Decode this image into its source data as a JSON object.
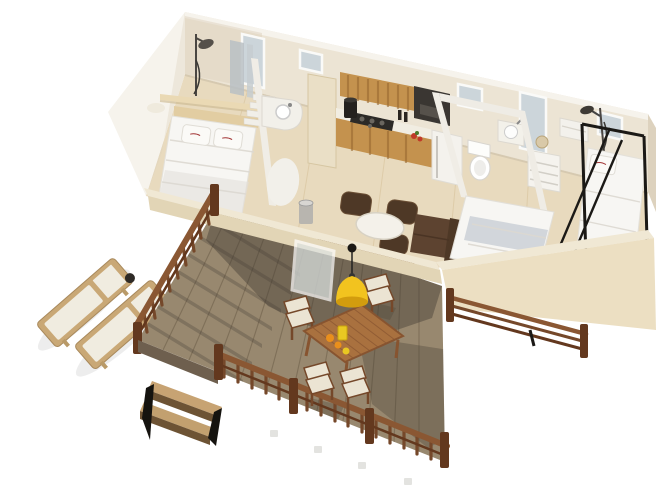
{
  "scene": {
    "description": "3D isometric cutaway rendering of a holiday mobile home with furnished interior and a wooden deck terrace, two sun loungers on the left, outdoor dining table with yellow pendant lamp on the deck",
    "building": {
      "areas": [
        {
          "name": "master-bedroom",
          "items": [
            "double-bed",
            "two-pillows-with-red-brand-mark",
            "headboard-shelf",
            "shower-column",
            "vanity-round-sink",
            "white-step-unit",
            "mirror-panels",
            "tall-window"
          ]
        },
        {
          "name": "kitchen",
          "items": [
            "cream-tall-cabinet",
            "wood-upper-cabinets",
            "range-hood",
            "cooktop",
            "coffee-maker",
            "counter",
            "fridge",
            "small-window"
          ]
        },
        {
          "name": "living-area",
          "items": [
            "brown-sofa",
            "three-brown-poufs",
            "white-oval-table",
            "metal-trash-bin",
            "brown-bench-cushion",
            "glass-entry-door"
          ]
        },
        {
          "name": "bathroom-wc",
          "items": [
            "toilet",
            "corner-washbasin",
            "drawer-unit",
            "window"
          ]
        },
        {
          "name": "kids-bedroom",
          "items": [
            "single-bed-grey-blanket",
            "bunk-bed-black-frame",
            "pillow-with-red-brand-mark",
            "wall-shower-head",
            "tall-window",
            "shelf-unit"
          ]
        }
      ]
    },
    "deck": {
      "items": [
        "decking-boards",
        "left-railing",
        "front-railing",
        "right-strip-railing",
        "two-step-stairs",
        "outdoor-dining-table",
        "four-folding-chairs-with-cream-cushions",
        "yellow-pendant-lamp",
        "oranges-and-lemon",
        "yellow-tumbler"
      ]
    },
    "garden": {
      "items": [
        "sun-lounger",
        "sun-lounger"
      ]
    }
  },
  "colors": {
    "bg": "#ffffff",
    "wall": "#ece4d4",
    "wall-bright": "#f6f3ec",
    "wall-shade": "#ddd2be",
    "floor": "#e8dabe",
    "floor-light": "#f0e6d0",
    "low-wall-top": "#f0e8d4",
    "low-wall-face": "#e2d5b6",
    "glass": "#ccd5da",
    "frame-white": "#fafaf8",
    "white-furniture": "#f3f1ea",
    "bedding": "#f7f6f3",
    "bedding-shade": "#e2dfd8",
    "blanket-gray": "#cdd3d8",
    "wood-cabinet": "#c4924e",
    "wood-cabinet-dark": "#96662e",
    "wood-light": "#eadfc6",
    "appliance": "#3a3632",
    "metal": "#b8b5af",
    "sofa": "#5d4330",
    "sofa-dark": "#4e3826",
    "pouf": "#4e3826",
    "cushion-brown": "#7a5336",
    "deck": "#98886f",
    "deck-seam": "#776852",
    "deck-shadow": "#413a31",
    "rail": "#8a5733",
    "rail-dark": "#63381e",
    "rail-mid": "#75482a",
    "step-wood": "#c7a373",
    "step-dark": "#6d5334",
    "lounger-wood": "#c9a876",
    "fabric": "#f0ece0",
    "out-table": "#a9713f",
    "out-table-dark": "#875430",
    "chair-cushion": "#ebe4d3",
    "lamp": "#f2c31f",
    "lamp-dark": "#d29c0e",
    "fruit-orange": "#e98f1c",
    "fruit-lemon": "#e9c822",
    "veg-red": "#c03a28",
    "black": "#1b1916",
    "logo-red": "#a23535"
  }
}
